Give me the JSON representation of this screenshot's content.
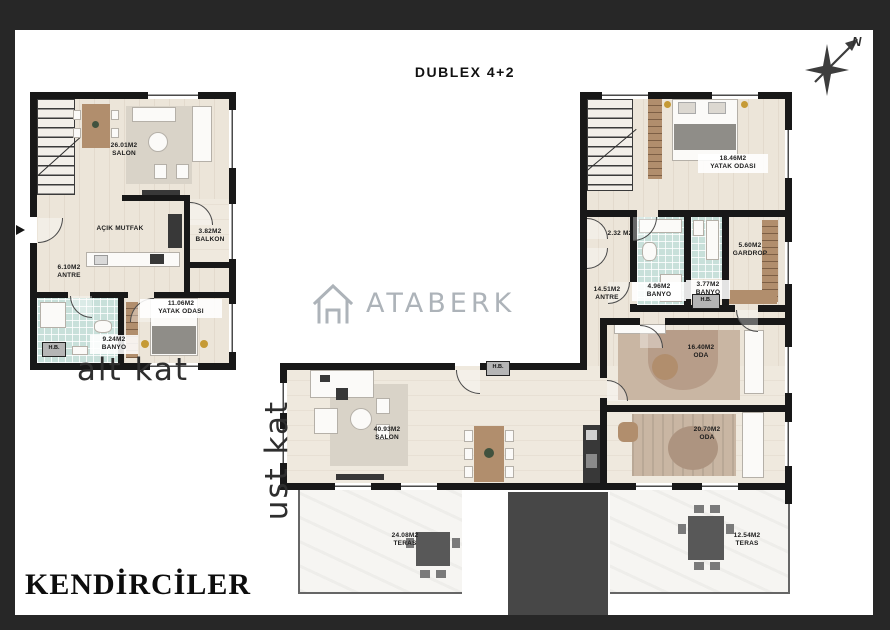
{
  "header": {
    "title": "DUBLEX 4+2"
  },
  "compass": {
    "north_label": "N"
  },
  "watermark": {
    "brand": "ATABERK"
  },
  "brand": {
    "name": "KENDİRCİLER"
  },
  "floors": {
    "alt": {
      "caption": "alt kat",
      "rooms": {
        "salon": {
          "area": "26.01M2",
          "name": "SALON"
        },
        "mutfak": {
          "name": "AÇIK MUTFAK"
        },
        "balkon": {
          "area": "3.82M2",
          "name": "BALKON"
        },
        "antre": {
          "area": "6.10M2",
          "name": "ANTRE"
        },
        "banyo": {
          "area": "9.24M2",
          "name": "BANYO"
        },
        "yatak": {
          "area": "11.06M2",
          "name": "YATAK ODASI"
        },
        "hb": {
          "name": "H.B."
        }
      }
    },
    "ust": {
      "caption": "ust kat",
      "rooms": {
        "yatak": {
          "area": "18.46M2",
          "name": "YATAK ODASI"
        },
        "wc": {
          "area": "2.32 M2"
        },
        "gardrop": {
          "area": "5.60M2",
          "name": "GARDROP"
        },
        "banyo1": {
          "area": "3.77M2",
          "name": "BANYO"
        },
        "banyo2": {
          "area": "4.96M2",
          "name": "BANYO"
        },
        "hb1": {
          "name": "H.B."
        },
        "hb2": {
          "name": "H.B."
        },
        "antre": {
          "area": "14.51M2",
          "name": "ANTRE"
        },
        "oda1": {
          "area": "16.40M2",
          "name": "ODA"
        },
        "oda2": {
          "area": "20.70M2",
          "name": "ODA"
        },
        "salon": {
          "area": "40.93M2",
          "name": "SALON"
        },
        "teras1": {
          "area": "24.08M2",
          "name": "TERAS"
        },
        "teras2": {
          "area": "12.54M2",
          "name": "TERAS"
        }
      }
    }
  },
  "colors": {
    "frame": "#272727",
    "wall": "#181818",
    "floor_wood": "#ece5d9",
    "bath_tile": "#c8e0da",
    "wood_accent": "#b18e6d",
    "terrace": "#f5f4f1",
    "roof_block": "#474747",
    "watermark_gray": "#99a1a8"
  }
}
